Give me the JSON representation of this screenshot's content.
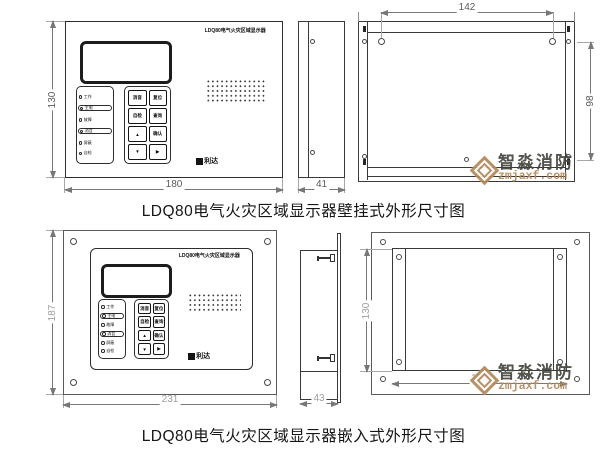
{
  "device": {
    "title": "LDQ80电气火灾区域显示器",
    "lamps": [
      "工作",
      "主电",
      "故障",
      "消音",
      "屏蔽",
      "自检"
    ],
    "buttons": [
      "消音",
      "复位",
      "自检",
      "查询",
      "▲",
      "确认",
      "▼",
      "▶"
    ],
    "logo": "利达"
  },
  "wall_mounted": {
    "caption": "LDQ80电气火灾区域显示器壁挂式外形尺寸图",
    "dims": {
      "front_width": "180",
      "front_height": "130",
      "side_depth": "41",
      "back_hole_span": "142",
      "back_hole_height": "98"
    }
  },
  "recessed": {
    "caption": "LDQ80电气火灾区域显示器嵌入式外形尺寸图",
    "dims": {
      "front_width": "231",
      "front_height": "187",
      "side_depth": "43",
      "back_width": "180",
      "back_height": "130"
    }
  },
  "watermark": {
    "brand": "智淼消防",
    "site": "zmjaxf.com",
    "accent": "#b5885a"
  }
}
